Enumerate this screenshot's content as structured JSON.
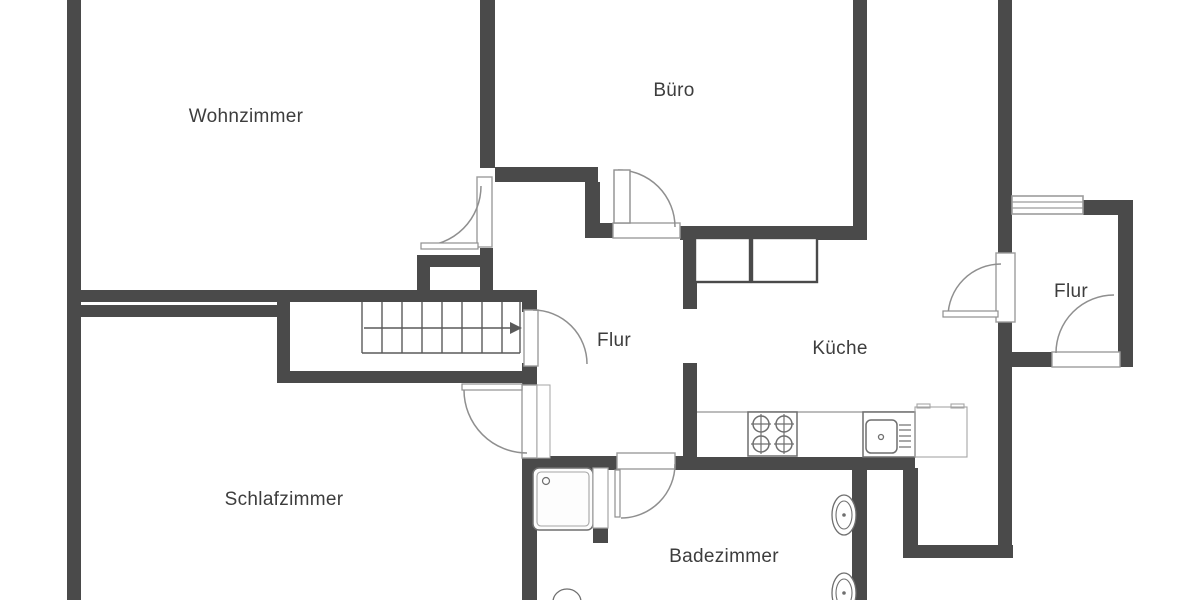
{
  "floorplan": {
    "colors": {
      "wall": "#4a4a4a",
      "arc": "#8f8f8f",
      "frame": "#9c9c9c",
      "fixture": "#6f6f6f",
      "fixture_light": "#a5a5a5",
      "stair_line": "#5a5a5a",
      "text": "#3d3d3d",
      "background": "#ffffff"
    },
    "rooms": [
      {
        "name": "Wohnzimmer",
        "x": 246,
        "y": 117
      },
      {
        "name": "Büro",
        "x": 674,
        "y": 91
      },
      {
        "name": "Flur",
        "x": 614,
        "y": 341
      },
      {
        "name": "Küche",
        "x": 840,
        "y": 349
      },
      {
        "name": "Flur",
        "x": 1071,
        "y": 292
      },
      {
        "name": "Schlafzimmer",
        "x": 284,
        "y": 500
      },
      {
        "name": "Badezimmer",
        "x": 724,
        "y": 557
      }
    ],
    "walls": [
      [
        67,
        0,
        14,
        600
      ],
      [
        480,
        0,
        15,
        168
      ],
      [
        853,
        0,
        14,
        240
      ],
      [
        998,
        0,
        14,
        558
      ],
      [
        81,
        290,
        456,
        12
      ],
      [
        81,
        305,
        196,
        12
      ],
      [
        277,
        293,
        13,
        90
      ],
      [
        277,
        371,
        260,
        12
      ],
      [
        522,
        290,
        15,
        22
      ],
      [
        522,
        363,
        15,
        22
      ],
      [
        522,
        458,
        15,
        142
      ],
      [
        495,
        167,
        103,
        15
      ],
      [
        585,
        182,
        15,
        56
      ],
      [
        598,
        223,
        15,
        15
      ],
      [
        680,
        226,
        187,
        14
      ],
      [
        683,
        226,
        14,
        83
      ],
      [
        683,
        363,
        14,
        99
      ],
      [
        522,
        456,
        96,
        14
      ],
      [
        674,
        456,
        23,
        14
      ],
      [
        697,
        457,
        218,
        13
      ],
      [
        852,
        470,
        15,
        130
      ],
      [
        903,
        468,
        15,
        90
      ],
      [
        903,
        545,
        110,
        13
      ],
      [
        1083,
        200,
        50,
        15
      ],
      [
        1118,
        215,
        15,
        152
      ],
      [
        1012,
        352,
        40,
        15
      ],
      [
        417,
        255,
        13,
        47
      ],
      [
        417,
        255,
        76,
        12
      ],
      [
        480,
        248,
        13,
        54
      ],
      [
        593,
        528,
        15,
        15
      ]
    ],
    "doors": [
      {
        "id": "door-wohnzimmer",
        "opening": [
          477,
          177,
          15,
          70
        ],
        "arc": "M421,246 A60,60 0 0 0 481,186",
        "leaf_line": [
          421,
          243,
          57,
          6
        ]
      },
      {
        "id": "door-buero",
        "opening": [
          613,
          223,
          67,
          15
        ],
        "arc": "M618,170 A57,57 0 0 1 675,227",
        "leaf_rect": [
          614,
          170,
          16,
          53
        ]
      },
      {
        "id": "door-treppe",
        "opening": [
          524,
          310,
          14,
          56
        ],
        "arc": "M533,310 A54,54 0 0 1 587,364"
      },
      {
        "id": "door-schlafzimmer",
        "opening": [
          522,
          385,
          15,
          73
        ],
        "frame": [
          537,
          385,
          13,
          73
        ],
        "arc": "M464,390 A63,63 0 0 0 527,453",
        "leaf_line": [
          462,
          384,
          60,
          6
        ]
      },
      {
        "id": "door-badezimmer",
        "opening": [
          617,
          453,
          58,
          16
        ],
        "arc": "M675,464 A54,54 0 0 1 621,518",
        "leaf_line": [
          615,
          470,
          5,
          47
        ]
      },
      {
        "id": "door-kueche",
        "opening": [
          996,
          253,
          19,
          69
        ],
        "arc": "M1001,264 A53,53 0 0 0 948,317",
        "leaf_line": [
          943,
          311,
          55,
          6
        ]
      },
      {
        "id": "door-eingang",
        "opening": [
          1052,
          352,
          68,
          15
        ],
        "arc": "M1056,353 A58,58 0 0 1 1114,295"
      }
    ],
    "window": {
      "rect": [
        1012,
        196,
        71,
        18
      ],
      "line_ys": [
        202,
        208
      ]
    },
    "stairs": {
      "tread_xs": [
        362,
        382,
        402,
        422,
        442,
        462,
        482,
        502,
        520
      ],
      "y0": 302,
      "y1": 353,
      "base_line": [
        362,
        353,
        520,
        353
      ],
      "arrow": {
        "shaft": [
          364,
          328,
          512,
          328
        ],
        "head": "522,328 510,322 510,334"
      }
    },
    "fixtures": {
      "counter_edge": [
        697,
        412,
        915,
        412
      ],
      "stove": {
        "rect": [
          748,
          412,
          49,
          44
        ],
        "burner_r": 8,
        "burners": [
          [
            761,
            424
          ],
          [
            784,
            424
          ],
          [
            761,
            444
          ],
          [
            784,
            444
          ]
        ]
      },
      "sink": {
        "rect": [
          863,
          412,
          52,
          45
        ],
        "basin": [
          866,
          420,
          31,
          33
        ],
        "drain": [
          881,
          437
        ],
        "line_x": [
          899,
          911
        ],
        "line_ys": [
          425,
          430,
          436,
          441,
          447
        ]
      },
      "appliance": {
        "rect": [
          915,
          407,
          52,
          50
        ],
        "bumps": [
          [
            917,
            404,
            13,
            4
          ],
          [
            951,
            404,
            13,
            4
          ]
        ]
      },
      "cabinets": [
        [
          695,
          238,
          55,
          44
        ],
        [
          752,
          238,
          65,
          44
        ]
      ],
      "shower": {
        "tray": [
          533,
          468,
          60,
          62
        ],
        "inner": [
          537,
          472,
          52,
          54
        ],
        "drain": [
          546,
          481
        ],
        "partition": [
          593,
          468,
          15,
          60
        ]
      },
      "toilets": [
        {
          "cx": 844,
          "cy": 515,
          "rx": 12,
          "ry": 20,
          "irx": 8,
          "iry": 14
        },
        {
          "cx": 844,
          "cy": 593,
          "rx": 12,
          "ry": 20,
          "irx": 8,
          "iry": 14
        }
      ],
      "pedestal": {
        "cx": 567,
        "cy": 602,
        "rx": 14,
        "ry": 13
      }
    }
  }
}
